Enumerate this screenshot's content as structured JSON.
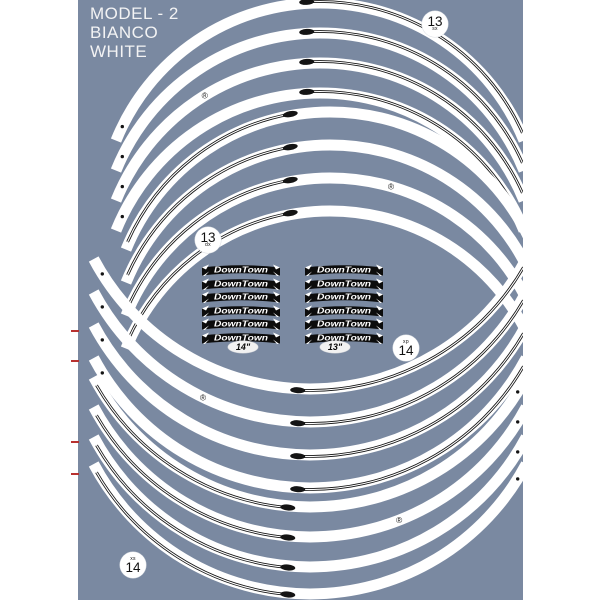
{
  "product_sheet": {
    "colors": {
      "page": "#ffffff",
      "sheet": "#7a89a1",
      "stripe": "#ffffff",
      "pinstripe": "#141414",
      "registration_mark": "#b8312f",
      "badge_bg": "#ffffff",
      "badge_text": "#111111",
      "banner_bg": "#0c0c0c",
      "banner_text": "#ffffff"
    },
    "header": {
      "line1": "MODEL - 2",
      "line2": "BIANCO",
      "line3": "WHITE"
    },
    "badges": {
      "top_right": {
        "number": "13",
        "sub": "sx"
      },
      "mid_left": {
        "number": "13",
        "sub": "dx"
      },
      "mid_right": {
        "number": "14",
        "sub": "xp"
      },
      "bottom_left": {
        "number": "14",
        "sub": "xs"
      }
    },
    "brand_block": {
      "brand": "DownTown",
      "columns": 2,
      "rows_per_column": 6,
      "left_column_size": "14\"",
      "right_column_size": "13\""
    },
    "stripes": {
      "registered_mark": "®",
      "groups": [
        {
          "id": "13-sx",
          "stripe_count": 4
        },
        {
          "id": "13-dx",
          "stripe_count": 4
        },
        {
          "id": "14-xp",
          "stripe_count": 4
        },
        {
          "id": "14-xs",
          "stripe_count": 4
        }
      ]
    }
  }
}
